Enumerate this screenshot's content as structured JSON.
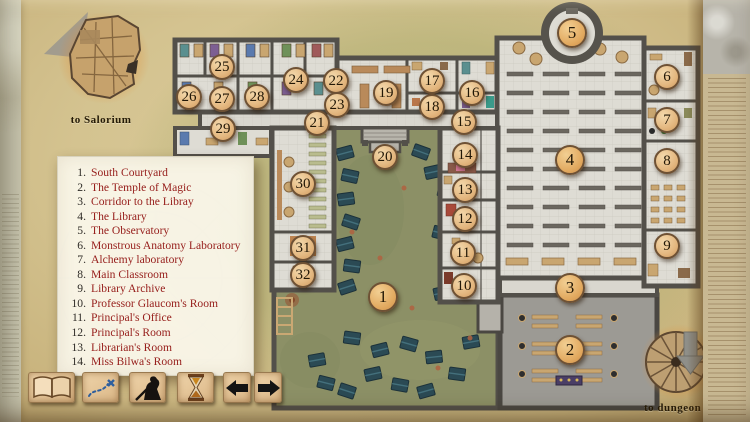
{
  "nav": {
    "salorium_label": "to Salorium",
    "dungeon_label": "to dungeon"
  },
  "legend": {
    "items": [
      {
        "num": "1.",
        "label": "South Courtyard"
      },
      {
        "num": "2.",
        "label": "The Temple of Magic"
      },
      {
        "num": "3.",
        "label": "Corridor to the Libray"
      },
      {
        "num": "4.",
        "label": "The Library"
      },
      {
        "num": "5.",
        "label": "The Observatory"
      },
      {
        "num": "6.",
        "label": "Monstrous Anatomy Laboratory"
      },
      {
        "num": "7.",
        "label": "Alchemy laboratory"
      },
      {
        "num": "8.",
        "label": "Main Classroom"
      },
      {
        "num": "9.",
        "label": "Library Archive"
      },
      {
        "num": "10.",
        "label": "Professor Glaucom's Room"
      },
      {
        "num": "11.",
        "label": "Principal's Office"
      },
      {
        "num": "12.",
        "label": "Principal's Room"
      },
      {
        "num": "13.",
        "label": "Librarian's Room"
      },
      {
        "num": "14.",
        "label": "Miss Bilwa's Room"
      }
    ]
  },
  "markers": [
    {
      "n": 1,
      "x": 383,
      "y": 297,
      "big": true
    },
    {
      "n": 2,
      "x": 570,
      "y": 350,
      "big": true
    },
    {
      "n": 3,
      "x": 570,
      "y": 288,
      "big": true
    },
    {
      "n": 4,
      "x": 570,
      "y": 160,
      "big": true
    },
    {
      "n": 5,
      "x": 572,
      "y": 33,
      "big": true
    },
    {
      "n": 6,
      "x": 667,
      "y": 77,
      "big": false
    },
    {
      "n": 7,
      "x": 667,
      "y": 120,
      "big": false
    },
    {
      "n": 8,
      "x": 667,
      "y": 161,
      "big": false
    },
    {
      "n": 9,
      "x": 667,
      "y": 246,
      "big": false
    },
    {
      "n": 10,
      "x": 464,
      "y": 286,
      "big": false
    },
    {
      "n": 11,
      "x": 463,
      "y": 253,
      "big": false
    },
    {
      "n": 12,
      "x": 465,
      "y": 219,
      "big": false
    },
    {
      "n": 13,
      "x": 465,
      "y": 190,
      "big": false
    },
    {
      "n": 14,
      "x": 465,
      "y": 155,
      "big": false
    },
    {
      "n": 15,
      "x": 464,
      "y": 122,
      "big": false
    },
    {
      "n": 16,
      "x": 472,
      "y": 93,
      "big": false
    },
    {
      "n": 17,
      "x": 432,
      "y": 81,
      "big": false
    },
    {
      "n": 18,
      "x": 432,
      "y": 107,
      "big": false
    },
    {
      "n": 19,
      "x": 386,
      "y": 93,
      "big": false
    },
    {
      "n": 20,
      "x": 385,
      "y": 157,
      "big": false
    },
    {
      "n": 21,
      "x": 317,
      "y": 123,
      "big": false
    },
    {
      "n": 22,
      "x": 336,
      "y": 81,
      "big": false
    },
    {
      "n": 23,
      "x": 337,
      "y": 105,
      "big": false
    },
    {
      "n": 24,
      "x": 296,
      "y": 80,
      "big": false
    },
    {
      "n": 25,
      "x": 222,
      "y": 67,
      "big": false
    },
    {
      "n": 26,
      "x": 189,
      "y": 97,
      "big": false
    },
    {
      "n": 27,
      "x": 222,
      "y": 99,
      "big": false
    },
    {
      "n": 28,
      "x": 257,
      "y": 97,
      "big": false
    },
    {
      "n": 29,
      "x": 223,
      "y": 129,
      "big": false
    },
    {
      "n": 30,
      "x": 303,
      "y": 184,
      "big": false
    },
    {
      "n": 31,
      "x": 303,
      "y": 248,
      "big": false
    },
    {
      "n": 32,
      "x": 303,
      "y": 275,
      "big": false
    }
  ],
  "toolbar": {
    "buttons": [
      {
        "icon": "open-book"
      },
      {
        "icon": "treasure-map"
      },
      {
        "icon": "adventurer"
      },
      {
        "icon": "hourglass"
      },
      {
        "icon": "arrow-left"
      },
      {
        "icon": "arrow-right"
      }
    ]
  },
  "colors": {
    "parchment": "#d4c390",
    "marker_fill": "#e3b67e",
    "marker_border": "#6e5134",
    "legend_text": "#97201d",
    "grass": "#8c9066",
    "tent": "#2b4a54",
    "wall": "#53504a",
    "floor": "#dedcd4",
    "temple_floor": "#9c9a94",
    "glow": "#e0903a"
  }
}
